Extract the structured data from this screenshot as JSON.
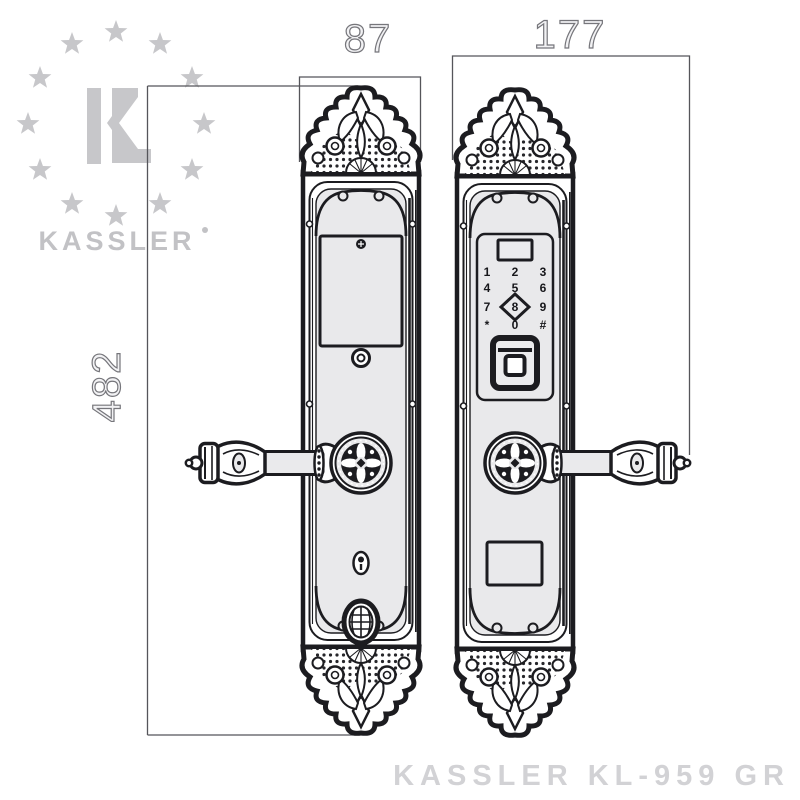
{
  "brand": {
    "logo_text": "KASSLER"
  },
  "dimensions": {
    "plate_width_mm": "87",
    "total_width_mm": "177",
    "height_mm": "482"
  },
  "keypad": {
    "keys": [
      "1",
      "2",
      "3",
      "4",
      "5",
      "6",
      "7",
      "8",
      "9",
      "*",
      "0",
      "#"
    ]
  },
  "footer": {
    "model_text": "KASSLER KL-959 GR"
  },
  "colors": {
    "line": "#1c1c20",
    "plate_fill": "#e9e9eb",
    "logo_gray": "#c7c7ca",
    "dimension_line": "#55555a",
    "dimension_text": "#76767b",
    "footer_text": "#d2d2d5"
  }
}
